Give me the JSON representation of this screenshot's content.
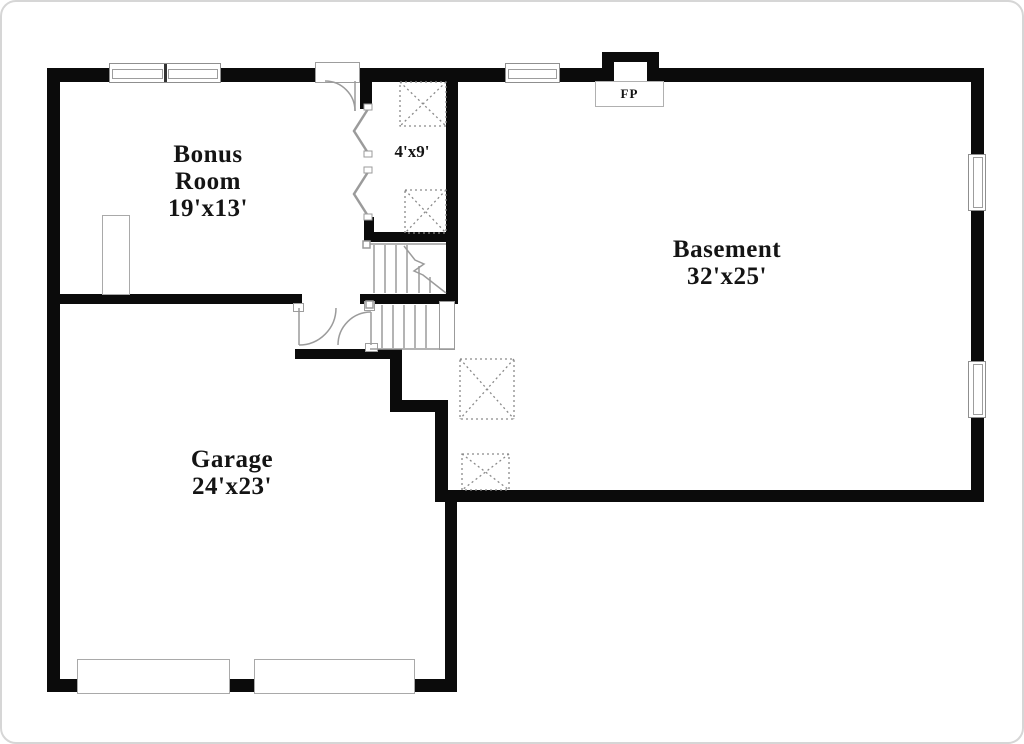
{
  "rooms": {
    "bonus": {
      "name": "Bonus Room",
      "dims": "19'x13'"
    },
    "basement": {
      "name": "Basement",
      "dims": "32'x25'"
    },
    "garage": {
      "name": "Garage",
      "dims": "24'x23'"
    },
    "hall": {
      "dims": "4'x9'"
    },
    "fireplace": {
      "label": "FP"
    }
  },
  "colors": {
    "wall": "#0b0b0b",
    "thin_line": "#9b9b9b",
    "hatch": "#8a8a8a",
    "background": "#ffffff",
    "frame": "#d6d6d6"
  }
}
